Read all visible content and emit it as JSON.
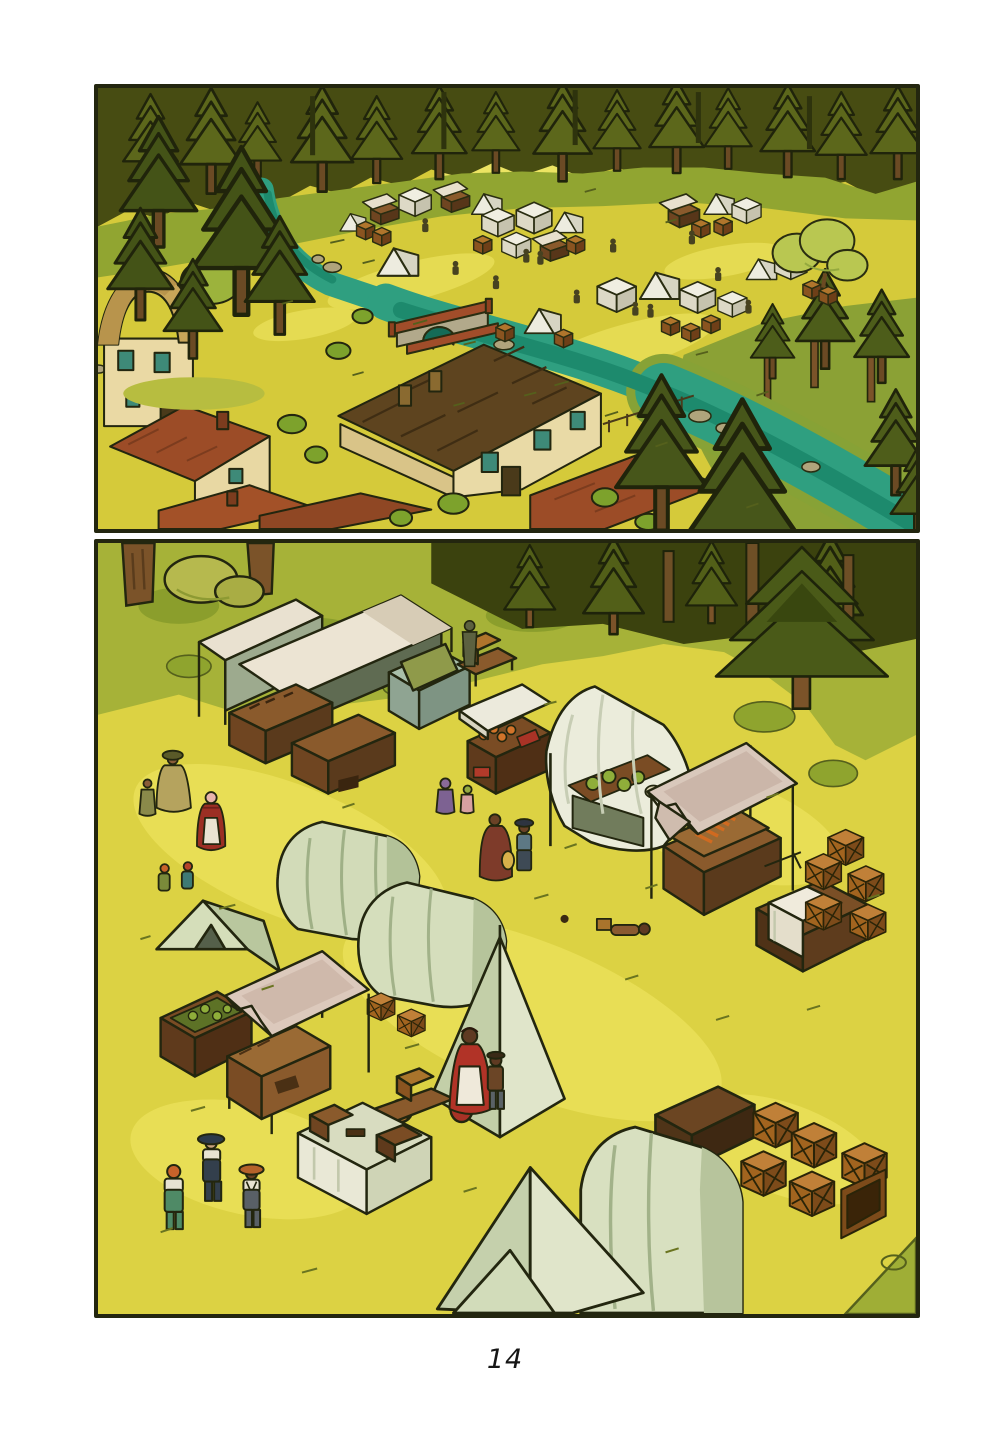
{
  "page": {
    "number_label": "14",
    "background": "#ffffff"
  },
  "comic": {
    "panel_count": 2,
    "panels": [
      {
        "name": "panel-top",
        "alt": "Aerial view of a village at a forest edge: a teal river crossed by a stone bridge with red brick rails, cream houses with red and dark brown roofs in the foreground, and a camp of white tents, market stalls and crates in a yellow meadow surrounded by pine forest"
      },
      {
        "name": "panel-bottom",
        "alt": "Closer view of the market clearing: canopied stalls with produce, gauze tents, draped pale-green tents, stacked wooden crates, tables with white cloths, and villagers including a woman in a red dress, children, and three men talking"
      }
    ]
  },
  "palette": {
    "meadow_yellow": "#d5ca3a",
    "meadow_light": "#e6dc55",
    "grass_green": "#a6b238",
    "forest_dark": "#474c12",
    "pine_green": "#4a5a18",
    "river_teal": "#2f9f80",
    "river_dark": "#1d8a6d",
    "bridge_stone": "#b2a98b",
    "brick_red": "#a14d2a",
    "house_cream": "#e9daa6",
    "roof_red": "#9c4c27",
    "roof_dark_brown": "#5e441f",
    "tent_white": "#edecdf",
    "tent_sage": "#d2dbb8",
    "canopy_pink": "#d9c8bb",
    "wood_brown": "#7a4f26",
    "crate_orange": "#b0752c",
    "outline": "#23260f",
    "dress_red": "#b13327"
  }
}
